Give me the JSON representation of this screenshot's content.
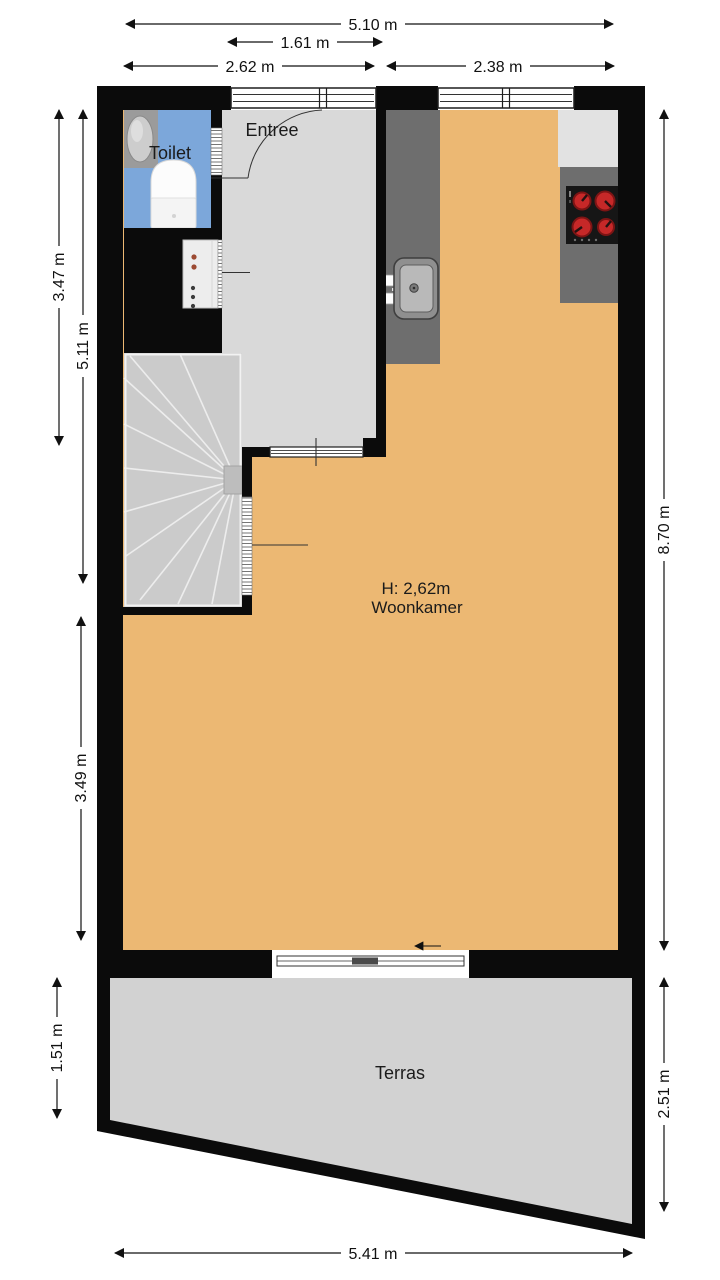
{
  "rooms": {
    "toilet": {
      "label": "Toilet"
    },
    "entree": {
      "label": "Entree"
    },
    "woonkamer": {
      "label": "Woonkamer",
      "height": "H: 2,62m"
    },
    "terras": {
      "label": "Terras"
    }
  },
  "dimensions": {
    "top_total": "5.10 m",
    "top_entree": "1.61 m",
    "top_left": "2.62 m",
    "top_right": "2.38 m",
    "left_upper": "3.47 m",
    "left_stairwell": "5.11 m",
    "left_lower": "3.49 m",
    "left_terras": "1.51 m",
    "right_house": "8.70 m",
    "right_terras": "2.51 m",
    "bottom_total": "5.41 m"
  },
  "colors": {
    "wall": "#0b0b0b",
    "woonkamer_floor": "#ECB873",
    "entree_floor": "#D9D9D9",
    "toilet_floor": "#7CA7DA",
    "terras_floor": "#D2D2D2",
    "counter_dark": "#6E6E6E",
    "counter_light": "#E2E2E2",
    "stove": "#161616",
    "burner": "#C62828",
    "stairs": "#CBCBCB"
  },
  "fixtures": {
    "sink": "kitchen-sink",
    "stove": "cooktop-4-burners",
    "toilet": "toilet-fixture",
    "basin": "hand-basin",
    "stairs": "winder-staircase",
    "cupboard": "meter-cupboard",
    "sliding_door": "sliding-door",
    "entrance_door": "entrance-door"
  }
}
